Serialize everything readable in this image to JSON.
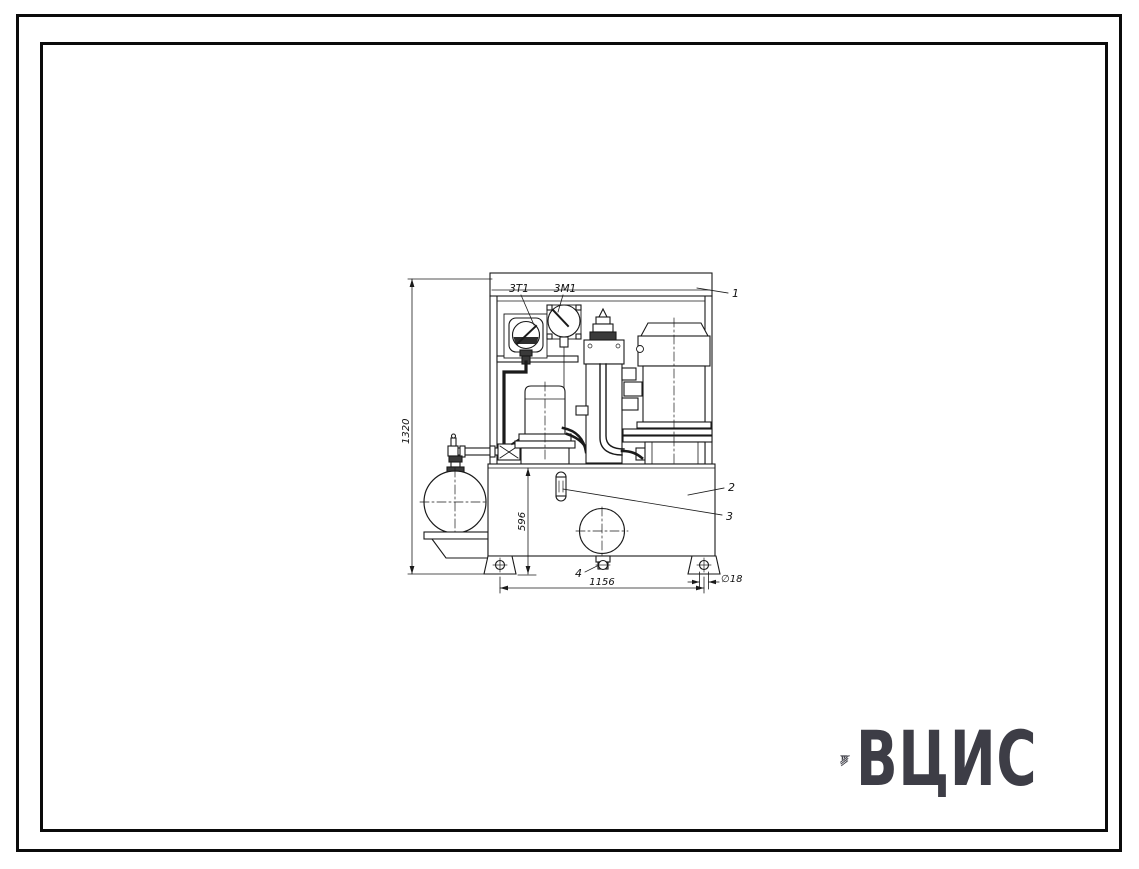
{
  "page": {
    "background": "#ffffff",
    "border_color": "#0b0b0b",
    "line_color": "#1a1a1a"
  },
  "drawing": {
    "title": "hydraulic-power-unit-front-view",
    "gauge_labels": {
      "gauge1": "3Т1",
      "gauge2": "3М1"
    },
    "callouts": {
      "c1": "1",
      "c2": "2",
      "c3": "3",
      "c4": "4"
    },
    "dimensions": {
      "overall_height": "1320",
      "tank_height": "596",
      "foot_span": "1156",
      "hole_diameter": "∅18"
    }
  },
  "logo": {
    "text": "ВЦИС",
    "color": "#3d3d46"
  }
}
